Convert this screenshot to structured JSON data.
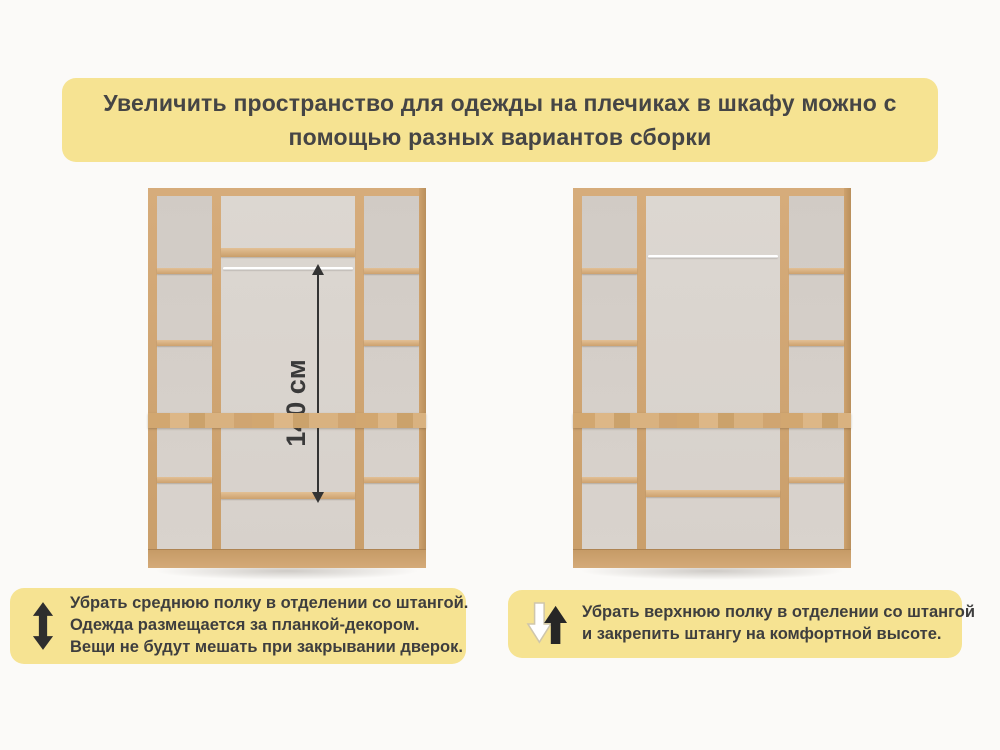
{
  "banner": {
    "lines": [
      "Увеличить пространство для одежды на плечиках в шкафу можно с",
      "помощью разных вариантов сборки"
    ]
  },
  "figures": {
    "left_wardrobe": {
      "dimension_label": "140 см",
      "features": "средняя полка снята, штанга под верхней полкой, одежда за планкой-декором"
    },
    "right_wardrobe": {
      "features": "верхняя полка снята, штанга закреплена вверху"
    }
  },
  "captions": {
    "left": {
      "icon": "updown-arrow-icon",
      "lines": [
        "Убрать среднюю полку в отделении со штангой.",
        "Одежда размещается за планкой-декором.",
        "Вещи не будут мешать при закрывании дверок."
      ]
    },
    "right": {
      "icon": "swap-arrows-icon",
      "lines": [
        "Убрать верхнюю полку в отделении со штангой",
        "и закрепить штангу на комфортной высоте."
      ]
    }
  },
  "colors": {
    "banner_bg": "#f6e392",
    "caption_bg": "#f6e392",
    "text_dark": "#3e3e3e",
    "wood": "#cda26e",
    "wood_light": "#e2c095",
    "back_panel": "#d7d1cb",
    "rod_white": "#f5f4f2",
    "arrow_dark": "#2e2e2e"
  }
}
